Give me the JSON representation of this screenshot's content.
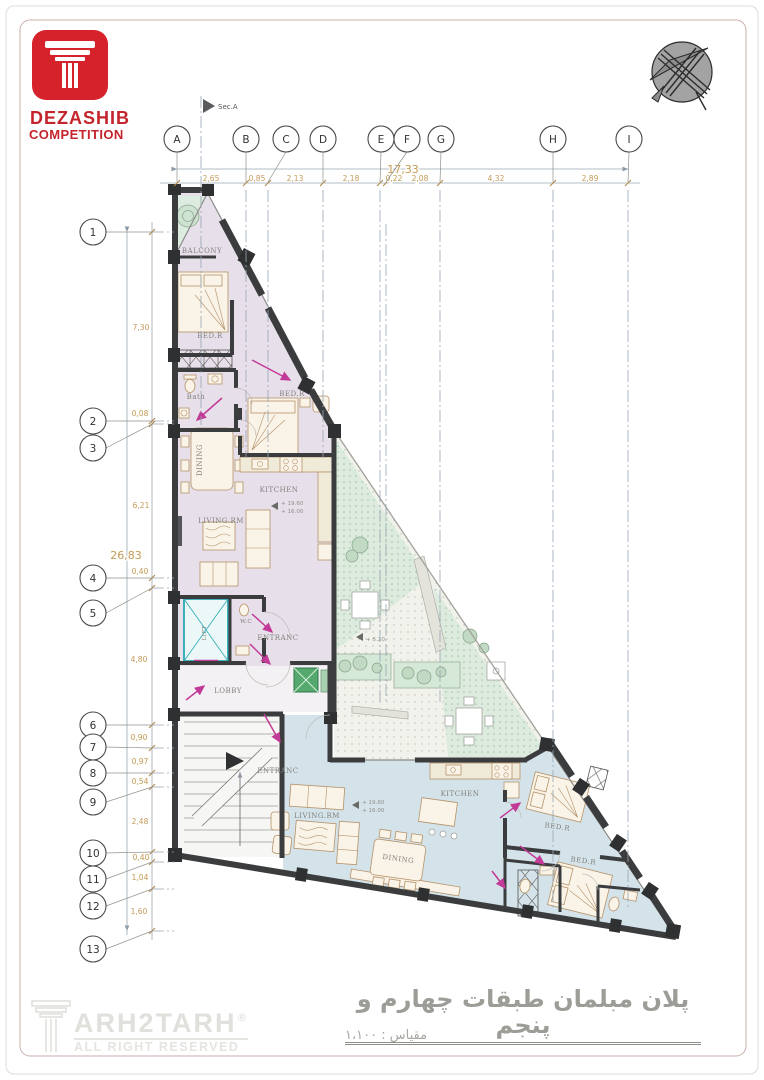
{
  "colors": {
    "accent_red": "#c4242c",
    "wall": "#3b3c3e",
    "upper_unit_fill": "#e7e0ea",
    "lower_unit_fill": "#d4e3ea",
    "courtyard_green": "#dcebde",
    "dimension_text": "#c49a5a",
    "magenta_arrow": "#c23a97",
    "lift_cyan": "#2aa9b5"
  },
  "header": {
    "logo_title": "DEZASHIB",
    "logo_subtitle": "COMPETITION"
  },
  "section_marker": "Sec.A",
  "grid": {
    "letters": [
      "A",
      "B",
      "C",
      "D",
      "E",
      "F",
      "G",
      "H",
      "I"
    ],
    "numbers": [
      "1",
      "2",
      "3",
      "4",
      "5",
      "6",
      "7",
      "8",
      "9",
      "10",
      "11",
      "12",
      "13"
    ]
  },
  "dimensions": {
    "top_total": "17,33",
    "top_segments": [
      "2,65",
      "0,85",
      "2,13",
      "2,18",
      "0,22",
      "2,08",
      "4,32",
      "2,89"
    ],
    "left_total": "26,83",
    "left_segments": [
      "7,30",
      "0,08",
      "6,21",
      "0,40",
      "4,80",
      "0,90",
      "0,97",
      "0,54",
      "2,48",
      "0,40",
      "1,04",
      "1,60"
    ]
  },
  "plan": {
    "labels": {
      "balcony": "BALCONY",
      "bedroom_upper_1": "BED.R",
      "bath": "Bath",
      "bedroom_upper_2": "BED.R",
      "dining_upper": "DINING",
      "kitchen_upper": "KITCHEN",
      "living_upper": "LIVING.RM",
      "lift": "LIFT",
      "wc": "W.C",
      "entrance_upper": "ENTRANC",
      "lobby": "LOBBY",
      "entrance_lower": "ENTRANC",
      "living_lower": "LIVING.RM",
      "kitchen_lower": "KITCHEN",
      "dining_lower": "DINING",
      "bedroom_lower_1": "BED.R",
      "bedroom_lower_2": "BED.R"
    },
    "levels": {
      "upper": [
        "+ 19.60",
        "+ 16.00"
      ],
      "lower": [
        "+ 19.60",
        "+ 16.00"
      ],
      "courtyard": "+ 5.20"
    }
  },
  "footer": {
    "title": "پلان مبلمان طبقات چهارم و پنجم",
    "scale": "مقیاس : ۱،۱۰۰",
    "watermark": "ARH2TARH",
    "registered": "®",
    "rights": "ALL RIGHT RESERVED"
  }
}
